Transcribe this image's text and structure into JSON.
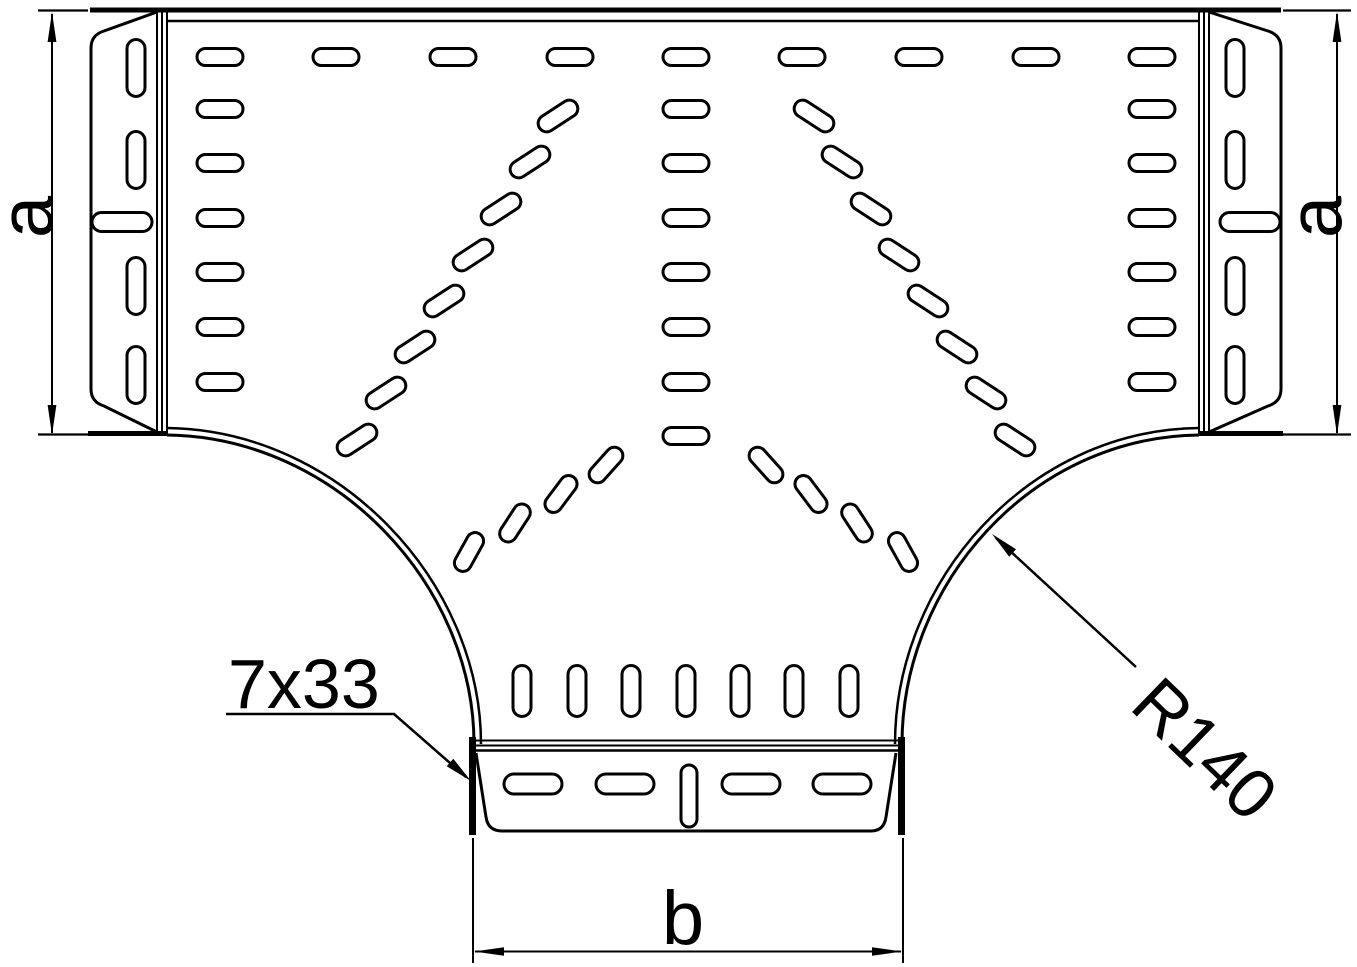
{
  "drawing": {
    "kind": "technical-drawing",
    "subject": "perforated cable tray tee - top view",
    "colors": {
      "line": "#000000",
      "background": "#ffffff"
    },
    "labels": {
      "width_left": "a",
      "width_right": "a",
      "branch_width": "b",
      "hole_callout": "7x33",
      "radius_callout": "R140"
    },
    "slot_groups": [
      {
        "name": "top-row",
        "w": 46,
        "h": 17,
        "cells": [
          [
            220,
            57
          ],
          [
            336,
            57
          ],
          [
            453,
            57
          ],
          [
            570,
            57
          ],
          [
            686,
            57
          ],
          [
            802,
            57
          ],
          [
            919,
            57
          ],
          [
            1036,
            57
          ],
          [
            1152,
            57
          ]
        ]
      },
      {
        "name": "left-column",
        "w": 46,
        "h": 17,
        "cells": [
          [
            220,
            109
          ],
          [
            220,
            163
          ],
          [
            220,
            218
          ],
          [
            220,
            272
          ],
          [
            220,
            327
          ],
          [
            220,
            382
          ]
        ]
      },
      {
        "name": "center-column",
        "w": 46,
        "h": 17,
        "cells": [
          [
            686,
            109
          ],
          [
            686,
            163
          ],
          [
            686,
            218
          ],
          [
            686,
            272
          ],
          [
            686,
            327
          ],
          [
            686,
            382
          ],
          [
            686,
            436
          ]
        ]
      },
      {
        "name": "right-column",
        "w": 46,
        "h": 17,
        "cells": [
          [
            1152,
            109
          ],
          [
            1152,
            163
          ],
          [
            1152,
            218
          ],
          [
            1152,
            272
          ],
          [
            1152,
            327
          ],
          [
            1152,
            382
          ]
        ]
      },
      {
        "name": "left-diagonal-fan",
        "w": 44,
        "h": 17,
        "angle": -33,
        "cells": [
          [
            558,
            116
          ],
          [
            530,
            162
          ],
          [
            501,
            209
          ],
          [
            473,
            255
          ],
          [
            444,
            301
          ],
          [
            415,
            347
          ],
          [
            386,
            393
          ],
          [
            357,
            440
          ]
        ]
      },
      {
        "name": "right-diagonal-fan",
        "w": 44,
        "h": 17,
        "angle": 33,
        "cells": [
          [
            814,
            116
          ],
          [
            842,
            162
          ],
          [
            871,
            209
          ],
          [
            899,
            255
          ],
          [
            928,
            301
          ],
          [
            957,
            347
          ],
          [
            986,
            393
          ],
          [
            1015,
            440
          ]
        ]
      },
      {
        "name": "left-inner-fan",
        "w": 42,
        "h": 17,
        "cells": [
          [
            606,
            465,
            -48
          ],
          [
            561,
            494,
            -53
          ],
          [
            515,
            523,
            -57
          ],
          [
            469,
            552,
            -61
          ]
        ]
      },
      {
        "name": "right-inner-fan",
        "w": 42,
        "h": 17,
        "cells": [
          [
            766,
            465,
            48
          ],
          [
            811,
            494,
            53
          ],
          [
            857,
            523,
            57
          ],
          [
            903,
            552,
            61
          ]
        ]
      },
      {
        "name": "branch-slot-row",
        "w": 18,
        "h": 51,
        "cells": [
          [
            522,
            691
          ],
          [
            577,
            691
          ],
          [
            631,
            691
          ],
          [
            686,
            691
          ],
          [
            740,
            691
          ],
          [
            794,
            691
          ],
          [
            849,
            691
          ]
        ]
      },
      {
        "name": "left-plate-slots",
        "w": 18,
        "h": 57,
        "cells": [
          [
            136,
            68
          ],
          [
            136,
            160
          ],
          [
            136,
            286
          ],
          [
            136,
            375
          ]
        ]
      },
      {
        "name": "left-plate-horizontal-slot",
        "w": 60,
        "h": 19,
        "cells": [
          [
            122,
            222
          ]
        ]
      },
      {
        "name": "right-plate-slots",
        "w": 18,
        "h": 57,
        "cells": [
          [
            1235,
            68
          ],
          [
            1235,
            160
          ],
          [
            1235,
            286
          ],
          [
            1235,
            375
          ]
        ]
      },
      {
        "name": "right-plate-horizontal-slot",
        "w": 60,
        "h": 19,
        "cells": [
          [
            1250,
            222
          ]
        ]
      },
      {
        "name": "flange-slot-row",
        "w": 58,
        "h": 20,
        "cells": [
          [
            533,
            784
          ],
          [
            625,
            784
          ],
          [
            751,
            784
          ],
          [
            842,
            784
          ]
        ]
      },
      {
        "name": "flange-center-slot",
        "w": 16,
        "h": 62,
        "cells": [
          [
            689,
            796
          ]
        ]
      }
    ]
  }
}
